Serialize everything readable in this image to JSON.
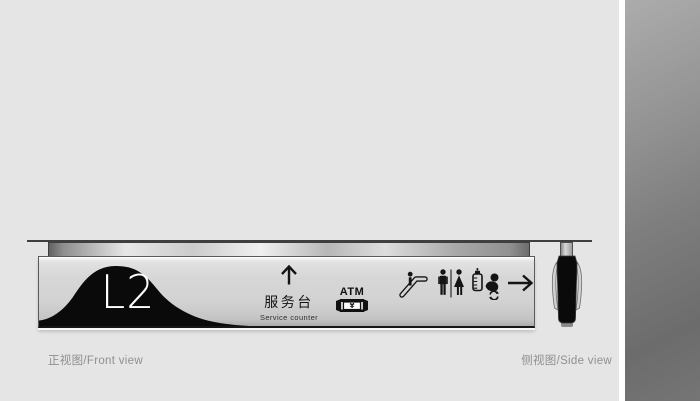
{
  "page": {
    "background_color": "#e5e5e5",
    "description_colors": {
      "sign_panel_silver": "#d2d2d2",
      "ink_black": "#0a0a0a",
      "caption_gray": "#8f8f8f",
      "swatch_gray_top": "#acacac",
      "swatch_gray_bottom": "#6c6c6c"
    }
  },
  "front_view": {
    "caption": "正视图/Front view",
    "level_badge": "L2",
    "service": {
      "direction_icon": "arrow-up-icon",
      "zh": "服务台",
      "en": "Service counter"
    },
    "atm": {
      "label": "ATM",
      "currency_symbol": "¥",
      "icon": "atm-machine-icon"
    },
    "pictograms": [
      {
        "name": "escalator-icon"
      },
      {
        "name": "restroom-icon"
      },
      {
        "name": "baby-care-icon"
      },
      {
        "name": "arrow-right-icon"
      }
    ]
  },
  "side_view": {
    "caption": "侧视图/Side view"
  }
}
